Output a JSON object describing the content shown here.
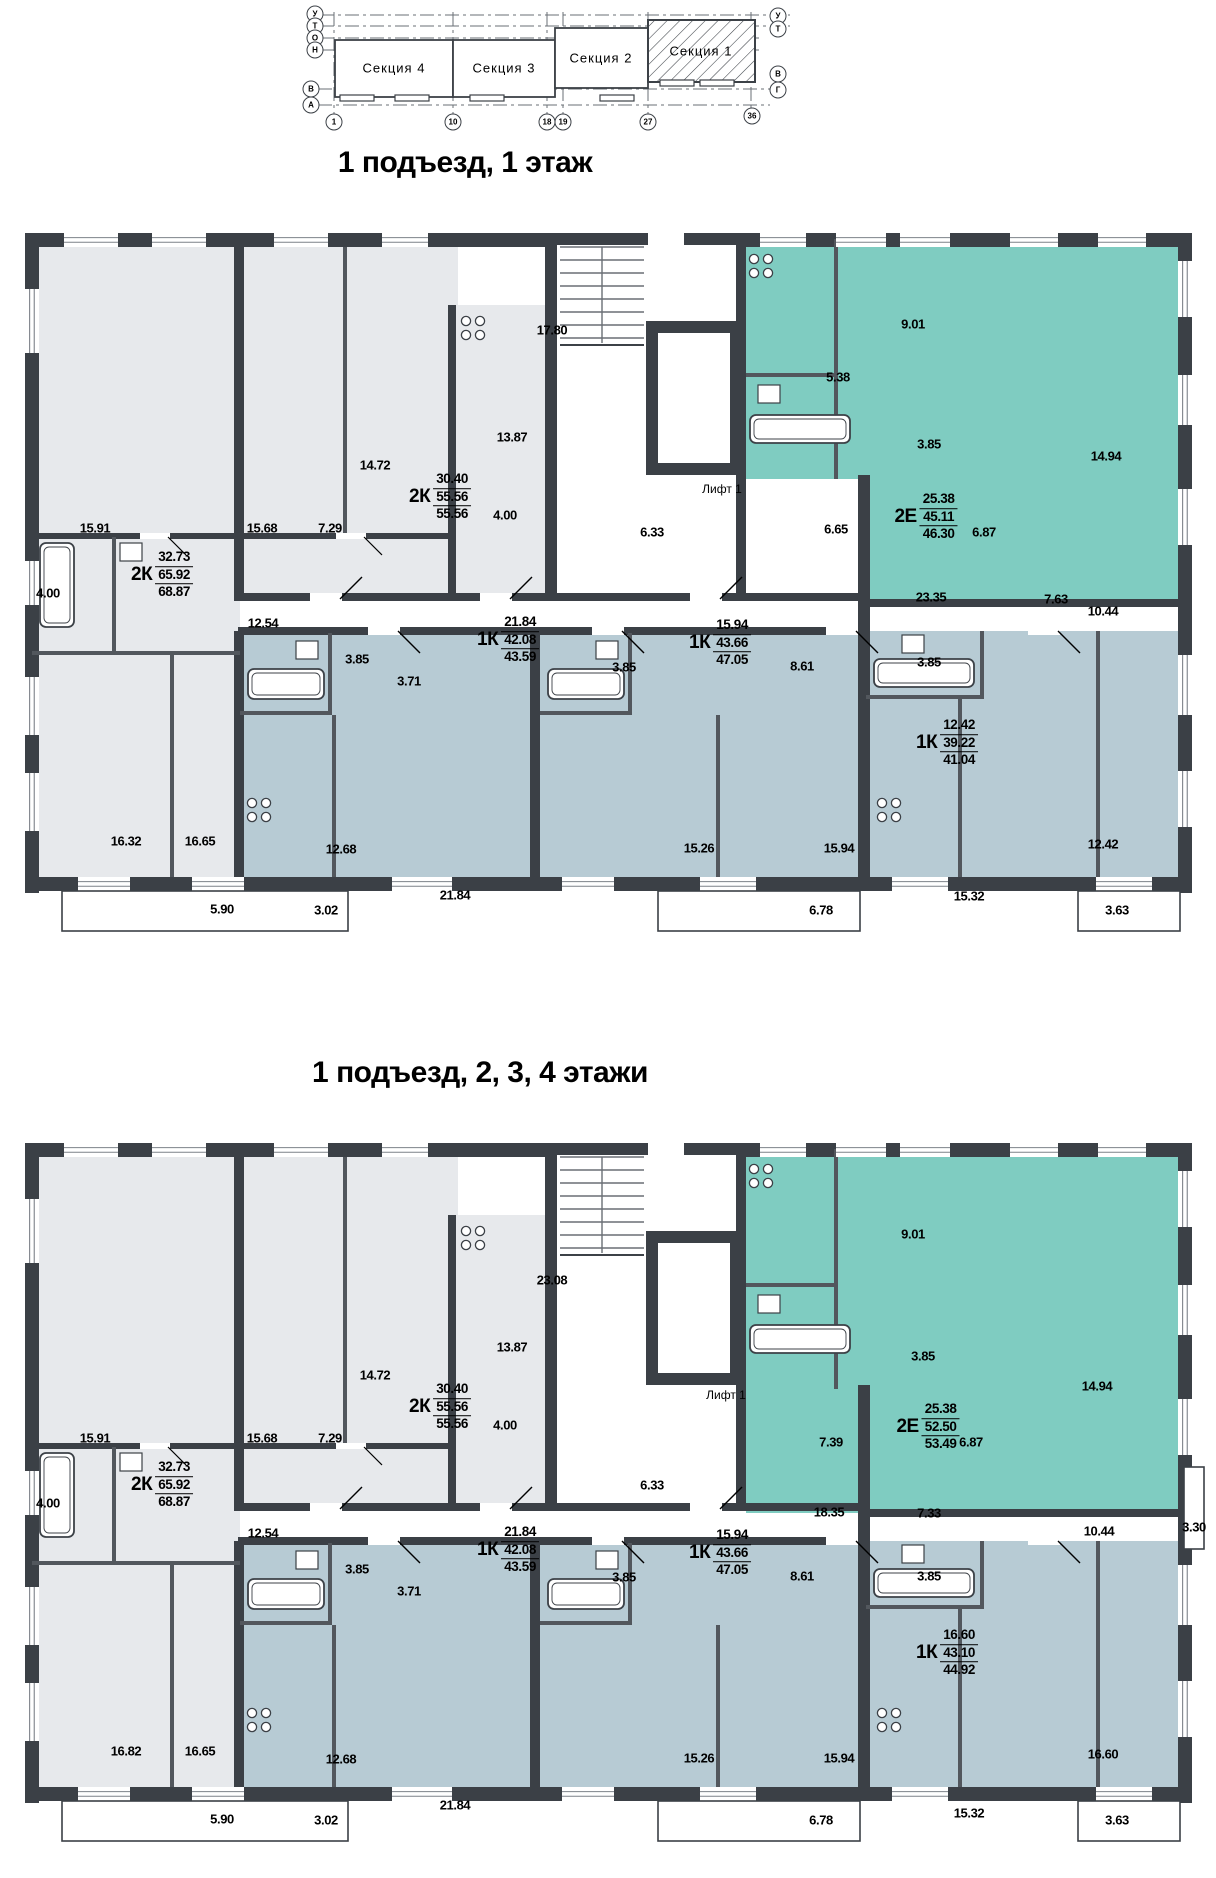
{
  "site_plan": {
    "sections": [
      {
        "label": "Секция 4"
      },
      {
        "label": "Секция 3"
      },
      {
        "label": "Секция 2"
      },
      {
        "label": "Секция 1"
      }
    ],
    "axis_letters": [
      {
        "label": "У",
        "x": 315,
        "y": 14
      },
      {
        "label": "Т",
        "x": 315,
        "y": 26
      },
      {
        "label": "О",
        "x": 315,
        "y": 38
      },
      {
        "label": "Н",
        "x": 315,
        "y": 50
      },
      {
        "label": "В",
        "x": 311,
        "y": 89
      },
      {
        "label": "А",
        "x": 311,
        "y": 105
      },
      {
        "label": "У",
        "x": 778,
        "y": 16
      },
      {
        "label": "Т",
        "x": 778,
        "y": 29
      },
      {
        "label": "В",
        "x": 778,
        "y": 74
      },
      {
        "label": "Г",
        "x": 778,
        "y": 90
      }
    ],
    "axis_numbers": [
      {
        "label": "1",
        "x": 334,
        "y": 122
      },
      {
        "label": "10",
        "x": 453,
        "y": 122
      },
      {
        "label": "18",
        "x": 547,
        "y": 122
      },
      {
        "label": "19",
        "x": 563,
        "y": 122
      },
      {
        "label": "27",
        "x": 648,
        "y": 122
      },
      {
        "label": "36",
        "x": 752,
        "y": 116
      }
    ]
  },
  "plans": [
    {
      "title": "1 подъезд, 1 этаж",
      "variant": "floor1",
      "lift": {
        "label": "Лифт 1",
        "x": 722,
        "y": 264
      },
      "apartments": [
        {
          "type": "2К",
          "values": [
            "30.40",
            "55.56",
            "55.56"
          ],
          "x": 440,
          "y": 272
        },
        {
          "type": "2К",
          "values": [
            "32.73",
            "65.92",
            "68.87"
          ],
          "x": 162,
          "y": 350
        },
        {
          "type": "2Е",
          "values": [
            "25.38",
            "45.11",
            "46.30"
          ],
          "x": 926,
          "y": 292
        },
        {
          "type": "1К",
          "values": [
            "21.84",
            "42.08",
            "43.59"
          ],
          "x": 508,
          "y": 415
        },
        {
          "type": "1К",
          "values": [
            "15.94",
            "43.66",
            "47.05"
          ],
          "x": 720,
          "y": 418
        },
        {
          "type": "1К",
          "values": [
            "12.42",
            "39.22",
            "41.04"
          ],
          "x": 947,
          "y": 518
        }
      ],
      "dims": [
        {
          "t": "15.91",
          "x": 95,
          "y": 303
        },
        {
          "t": "14.72",
          "x": 375,
          "y": 240
        },
        {
          "t": "15.68",
          "x": 262,
          "y": 303
        },
        {
          "t": "7.29",
          "x": 330,
          "y": 303
        },
        {
          "t": "13.87",
          "x": 512,
          "y": 212
        },
        {
          "t": "4.00",
          "x": 505,
          "y": 290
        },
        {
          "t": "4.00",
          "x": 48,
          "y": 368
        },
        {
          "t": "12.54",
          "x": 263,
          "y": 398
        },
        {
          "t": "16.32",
          "x": 126,
          "y": 616
        },
        {
          "t": "16.65",
          "x": 200,
          "y": 616
        },
        {
          "t": "5.90",
          "x": 222,
          "y": 684
        },
        {
          "t": "3.02",
          "x": 326,
          "y": 685
        },
        {
          "t": "17.80",
          "x": 552,
          "y": 105
        },
        {
          "t": "6.33",
          "x": 652,
          "y": 307
        },
        {
          "t": "6.65",
          "x": 836,
          "y": 304
        },
        {
          "t": "5.38",
          "x": 838,
          "y": 152
        },
        {
          "t": "9.01",
          "x": 913,
          "y": 99
        },
        {
          "t": "3.85",
          "x": 929,
          "y": 219
        },
        {
          "t": "6.87",
          "x": 984,
          "y": 307
        },
        {
          "t": "14.94",
          "x": 1106,
          "y": 231
        },
        {
          "t": "10.44",
          "x": 1103,
          "y": 386
        },
        {
          "t": "23.35",
          "x": 931,
          "y": 372
        },
        {
          "t": "7.63",
          "x": 1056,
          "y": 374
        },
        {
          "t": "3.85",
          "x": 357,
          "y": 434
        },
        {
          "t": "3.71",
          "x": 409,
          "y": 456
        },
        {
          "t": "12.68",
          "x": 341,
          "y": 624
        },
        {
          "t": "21.84",
          "x": 455,
          "y": 670
        },
        {
          "t": "3.85",
          "x": 624,
          "y": 442
        },
        {
          "t": "8.61",
          "x": 802,
          "y": 441
        },
        {
          "t": "15.26",
          "x": 699,
          "y": 623
        },
        {
          "t": "15.94",
          "x": 839,
          "y": 623
        },
        {
          "t": "6.78",
          "x": 821,
          "y": 685
        },
        {
          "t": "3.85",
          "x": 929,
          "y": 437
        },
        {
          "t": "12.42",
          "x": 1103,
          "y": 619
        },
        {
          "t": "15.32",
          "x": 969,
          "y": 671
        },
        {
          "t": "3.63",
          "x": 1117,
          "y": 685
        }
      ]
    },
    {
      "title": "1 подъезд, 2, 3, 4 этажи",
      "variant": "floor234",
      "lift": {
        "label": "Лифт 1",
        "x": 726,
        "y": 260
      },
      "apartments": [
        {
          "type": "2К",
          "values": [
            "30.40",
            "55.56",
            "55.56"
          ],
          "x": 440,
          "y": 272
        },
        {
          "type": "2К",
          "values": [
            "32.73",
            "65.92",
            "68.87"
          ],
          "x": 162,
          "y": 350
        },
        {
          "type": "2Е",
          "values": [
            "25.38",
            "52.50",
            "53.49"
          ],
          "x": 928,
          "y": 292
        },
        {
          "type": "1К",
          "values": [
            "21.84",
            "42.08",
            "43.59"
          ],
          "x": 508,
          "y": 415
        },
        {
          "type": "1К",
          "values": [
            "15.94",
            "43.66",
            "47.05"
          ],
          "x": 720,
          "y": 418
        },
        {
          "type": "1К",
          "values": [
            "16.60",
            "43.10",
            "44.92"
          ],
          "x": 947,
          "y": 518
        }
      ],
      "dims": [
        {
          "t": "15.91",
          "x": 95,
          "y": 303
        },
        {
          "t": "14.72",
          "x": 375,
          "y": 240
        },
        {
          "t": "15.68",
          "x": 262,
          "y": 303
        },
        {
          "t": "7.29",
          "x": 330,
          "y": 303
        },
        {
          "t": "13.87",
          "x": 512,
          "y": 212
        },
        {
          "t": "4.00",
          "x": 505,
          "y": 290
        },
        {
          "t": "4.00",
          "x": 48,
          "y": 368
        },
        {
          "t": "12.54",
          "x": 263,
          "y": 398
        },
        {
          "t": "23.08",
          "x": 552,
          "y": 145
        },
        {
          "t": "6.33",
          "x": 652,
          "y": 350
        },
        {
          "t": "9.01",
          "x": 913,
          "y": 99
        },
        {
          "t": "3.85",
          "x": 923,
          "y": 221
        },
        {
          "t": "6.87",
          "x": 971,
          "y": 307
        },
        {
          "t": "14.94",
          "x": 1097,
          "y": 251
        },
        {
          "t": "10.44",
          "x": 1099,
          "y": 396
        },
        {
          "t": "7.39",
          "x": 831,
          "y": 307
        },
        {
          "t": "18.35",
          "x": 829,
          "y": 377
        },
        {
          "t": "7.33",
          "x": 929,
          "y": 378
        },
        {
          "t": "3.85",
          "x": 357,
          "y": 434
        },
        {
          "t": "3.71",
          "x": 409,
          "y": 456
        },
        {
          "t": "12.68",
          "x": 341,
          "y": 624
        },
        {
          "t": "21.84",
          "x": 455,
          "y": 670
        },
        {
          "t": "3.85",
          "x": 624,
          "y": 442
        },
        {
          "t": "8.61",
          "x": 802,
          "y": 441
        },
        {
          "t": "15.26",
          "x": 699,
          "y": 623
        },
        {
          "t": "15.94",
          "x": 839,
          "y": 623
        },
        {
          "t": "6.78",
          "x": 821,
          "y": 685
        },
        {
          "t": "3.85",
          "x": 929,
          "y": 441
        },
        {
          "t": "16.82",
          "x": 126,
          "y": 616
        },
        {
          "t": "16.65",
          "x": 200,
          "y": 616
        },
        {
          "t": "5.90",
          "x": 222,
          "y": 684
        },
        {
          "t": "3.02",
          "x": 326,
          "y": 685
        },
        {
          "t": "16.60",
          "x": 1103,
          "y": 619
        },
        {
          "t": "15.32",
          "x": 969,
          "y": 678
        },
        {
          "t": "3.63",
          "x": 1117,
          "y": 685
        },
        {
          "t": "3.30",
          "x": 1194,
          "y": 392
        }
      ]
    }
  ],
  "colors": {
    "wall": "#3b4046",
    "room_gray": "#e7e9ec",
    "room_teal": "#7fccc1",
    "room_blue": "#b7cbd4",
    "line": "#52575d"
  }
}
